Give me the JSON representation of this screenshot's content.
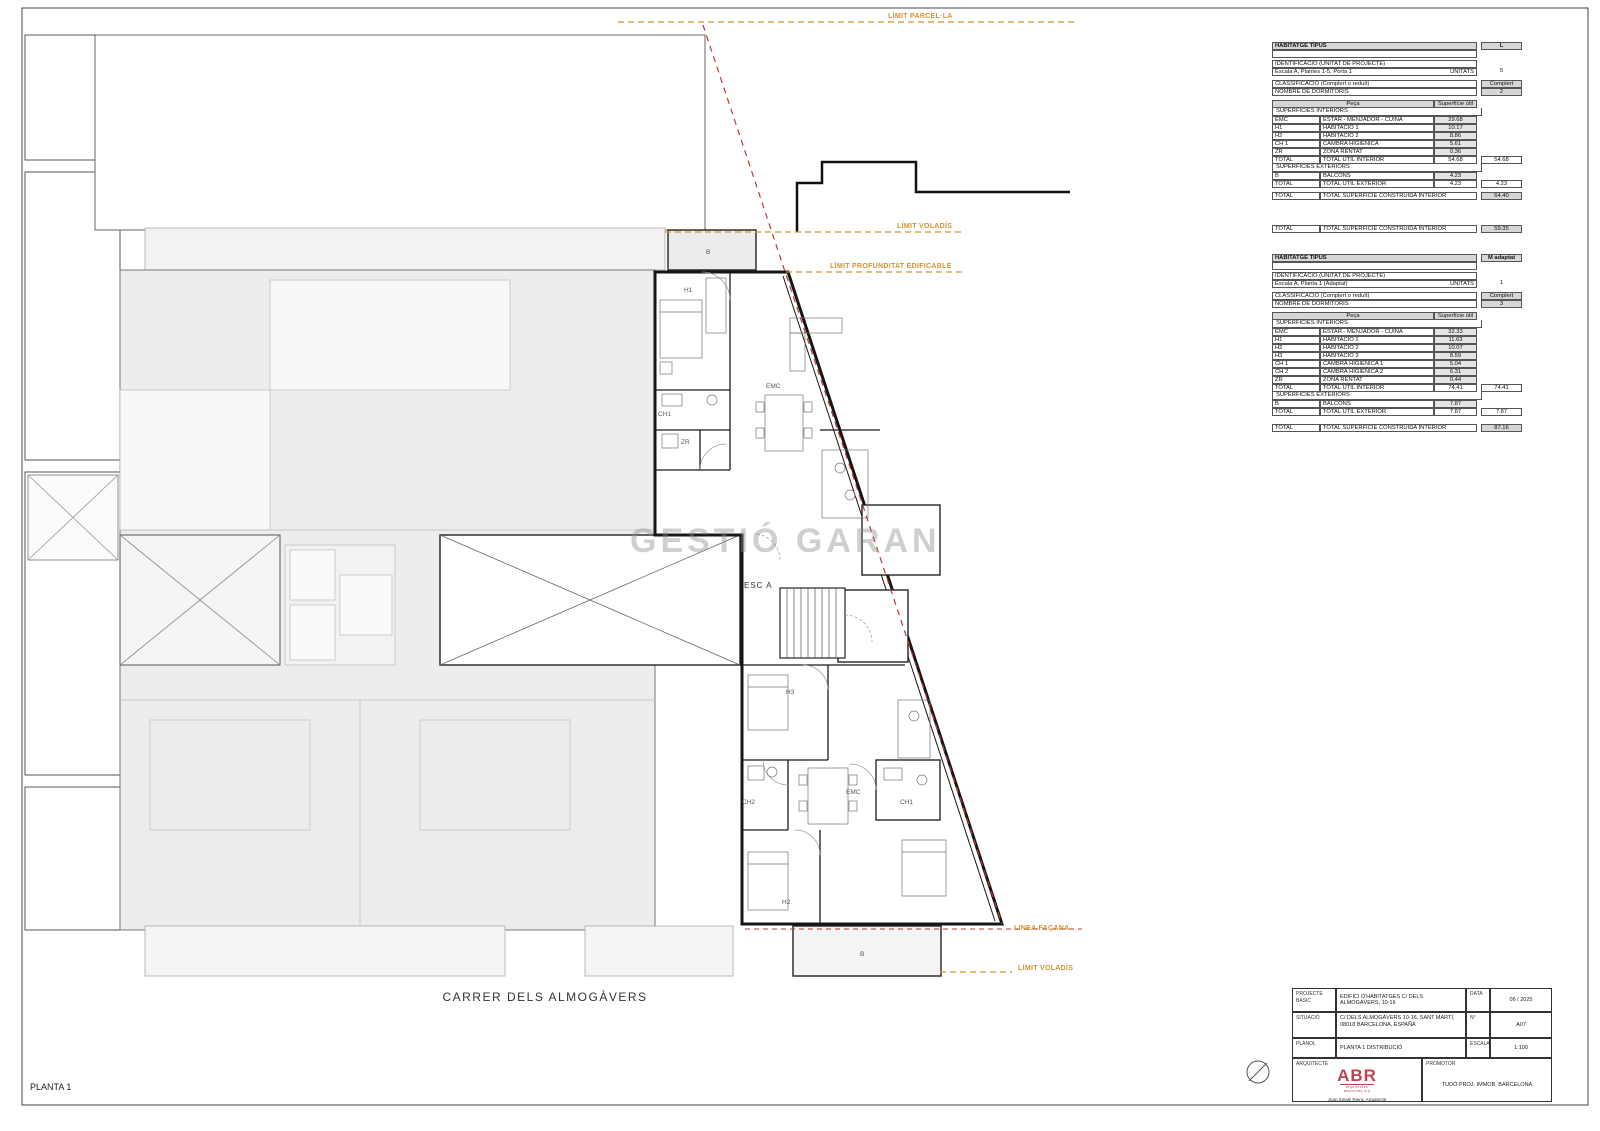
{
  "colors": {
    "accent_orange": "#d4922f",
    "accent_red": "#bb3a33",
    "wall_black": "#161616",
    "neighbor_gray": "#ededed",
    "table_header_gray": "#d6d6d6",
    "value_cell_gray": "#e4e4e4",
    "logo_red": "#c0424c"
  },
  "sheet": {
    "plan_title": "PLANTA 1",
    "street_label": "CARRER DELS ALMOGÀVERS",
    "watermark": "GESTIÓ GARANTIA",
    "stair_label": "ESC A"
  },
  "plan": {
    "limits": {
      "parcella": "LÍMIT PARCEL·LA",
      "voladis_top": "LÍMIT VOLADÍS",
      "profunditat": "LÍMIT PROFUNDITAT EDIFICABLE",
      "facana": "LINEA FAÇANA",
      "voladis_bottom": "LÍMIT VOLADÍS"
    },
    "rooms_upper": {
      "h1": "H1",
      "emc": "EMC",
      "ch1": "CH1",
      "zr": "ZR",
      "balcony": "B"
    },
    "rooms_lower": {
      "h3": "H3",
      "emc": "EMC",
      "ch2": "CH2",
      "ch1": "CH1",
      "h2": "H2",
      "balcony": "B"
    }
  },
  "tables": {
    "t1": {
      "tipus_label": "HABITATGE TIPUS",
      "tipus_value": "L",
      "ident_label": "IDENTIFICACIÓ (UNITAT DE PROJECTE)",
      "ident_value": "Escala A, Plantes 1-5, Porta 1",
      "unitats_label": "UNITATS",
      "unitats_value": "5",
      "classif_label": "CLASSIFICACIÓ (Complert o reduït)",
      "classif_value": "Complert",
      "dorm_label": "NOMBRE DE DORMITORIS",
      "dorm_value": "2",
      "col_peca": "Peça",
      "col_sup": "Superfície útil",
      "int_header": "SUPERFÍCIES INTERIORS",
      "int_rows": [
        {
          "code": "EMC",
          "name": "ESTAR - MENJADOR - CUINA",
          "value": "29.68"
        },
        {
          "code": "H1",
          "name": "HABITACIÓ 1",
          "value": "10.17"
        },
        {
          "code": "H2",
          "name": "HABITACIÓ 2",
          "value": "8.86"
        },
        {
          "code": "CH 1",
          "name": "CAMBRA HIGIÈNICA",
          "value": "5.61"
        },
        {
          "code": "ZR",
          "name": "ZONA RENTAT",
          "value": "0.36"
        }
      ],
      "int_total": {
        "code": "TOTAL",
        "name": "TOTAL ÚTIL INTERIOR",
        "value": "54.68",
        "total": "54.68"
      },
      "ext_header": "SUPERFÍCIES EXTERIORS",
      "ext_rows": [
        {
          "code": "B",
          "name": "BALCONS",
          "value": "4.23"
        }
      ],
      "ext_total": {
        "code": "TOTAL",
        "name": "TOTAL ÚTIL EXTERIOR",
        "value": "4.23",
        "total": "4.23"
      },
      "built_total": {
        "code": "TOTAL",
        "name": "TOTAL SUPERFÍCIE CONSTRUÏDA INTERIOR",
        "total": "64.40"
      }
    },
    "mid_total": {
      "code": "TOTAL",
      "name": "TOTAL SUPERFÍCIE CONSTRUÏDA INTERIOR",
      "total": "59.35"
    },
    "t2": {
      "tipus_label": "HABITATGE TIPUS",
      "tipus_value": "M adaptat",
      "ident_label": "IDENTIFICACIÓ (UNITAT DE PROJECTE)",
      "ident_value": "Escala A, Planta 1 (Adaptat)",
      "unitats_label": "UNITATS",
      "unitats_value": "1",
      "classif_label": "CLASSIFICACIÓ (Complert o reduït)",
      "classif_value": "Complert",
      "dorm_label": "NOMBRE DE DORMITORIS",
      "dorm_value": "3",
      "col_peca": "Peça",
      "col_sup": "Superfície útil",
      "int_header": "SUPERFÍCIES INTERIORS",
      "int_rows": [
        {
          "code": "EMC",
          "name": "ESTAR - MENJADOR - CUINA",
          "value": "32.33"
        },
        {
          "code": "H1",
          "name": "HABITACIÓ 1",
          "value": "11.63"
        },
        {
          "code": "H2",
          "name": "HABITACIÓ 2",
          "value": "10.07"
        },
        {
          "code": "H3",
          "name": "HABITACIÓ 3",
          "value": "8.59"
        },
        {
          "code": "CH 1",
          "name": "CAMBRA HIGIÈNICA 1",
          "value": "5.04"
        },
        {
          "code": "CH 2",
          "name": "CAMBRA HIGIÈNICA 2",
          "value": "6.31"
        },
        {
          "code": "ZR",
          "name": "ZONA RENTAT",
          "value": "0.44"
        }
      ],
      "int_total": {
        "code": "TOTAL",
        "name": "TOTAL ÚTIL INTERIOR",
        "value": "74.41",
        "total": "74.41"
      },
      "ext_header": "SUPERFÍCIES EXTERIORS",
      "ext_rows": [
        {
          "code": "B",
          "name": "BALCONS",
          "value": "7.87"
        }
      ],
      "ext_total": {
        "code": "TOTAL",
        "name": "TOTAL ÚTIL EXTERIOR",
        "value": "7.87",
        "total": "7.87"
      },
      "built_total": {
        "code": "TOTAL",
        "name": "TOTAL SUPERFÍCIE CONSTRUÏDA INTERIOR",
        "total": "87.16"
      }
    }
  },
  "titleblock": {
    "projecte_label": "PROJECTE",
    "projecte_label2": "BÀSIC",
    "projecte_value": "EDIFICI D'HABITATGES C/ DELS ALMOGÀVERS, 10-16",
    "data_label": "DATA",
    "data_value": "06 / 2025",
    "situacio_label": "SITUACIÓ",
    "situacio_value": "C/ DELS ALMOGÀVERS 10-16, SANT MARTÍ, 08018 BARCELONA, ESPAÑA",
    "num_label": "N°",
    "num_value": "A07",
    "planol_label": "PLÀNOL",
    "planol_value": "PLANTA 1 DISTRIBUCIÓ",
    "escala_label": "ESCALA",
    "escala_value": "1:100",
    "arquitecte_label": "ARQUITECTE",
    "logo": "ABR",
    "logo_caption": "arquitectes associats slp",
    "arch_line1": "Joan Ignasi Riera, Arquitecte",
    "arch_line2": "ABR | arquitectes associats S.L.P",
    "promotor_label": "PROMOTOR",
    "promotor_value": "TUDÓ PROJ. IMMOB. BARCELONA"
  }
}
